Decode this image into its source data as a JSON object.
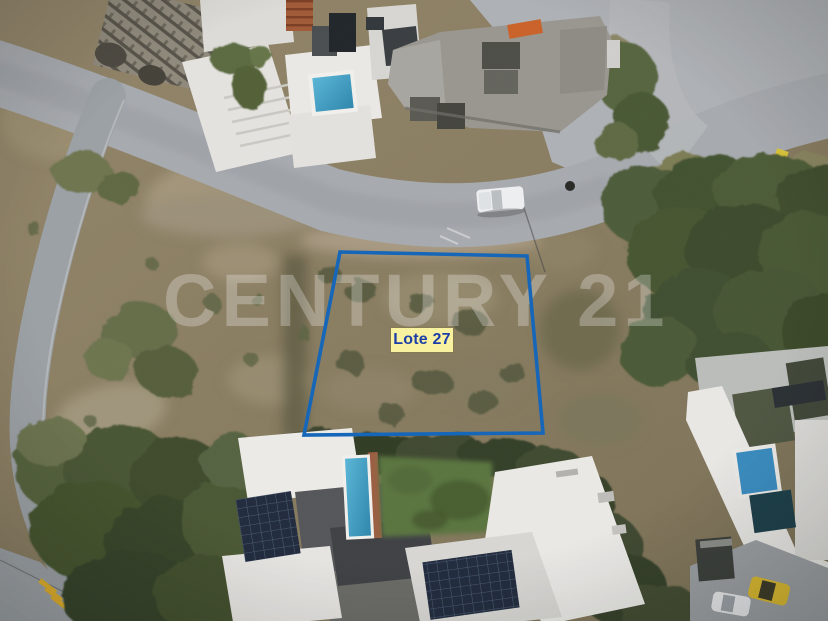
{
  "photo": {
    "description": "Aerial drone photograph of a vacant hillside lot for sale, outlined in blue, surrounded by modern houses, roads and vegetation",
    "watermark": {
      "text": "CENTURY 21",
      "color": "#ffffff",
      "opacity": "0.27"
    },
    "lot": {
      "label": "Lote 27",
      "boundary_color": "#1565b8",
      "label_bg_color": "#f8f1a0",
      "label_text_color": "#1d3ea7"
    }
  }
}
